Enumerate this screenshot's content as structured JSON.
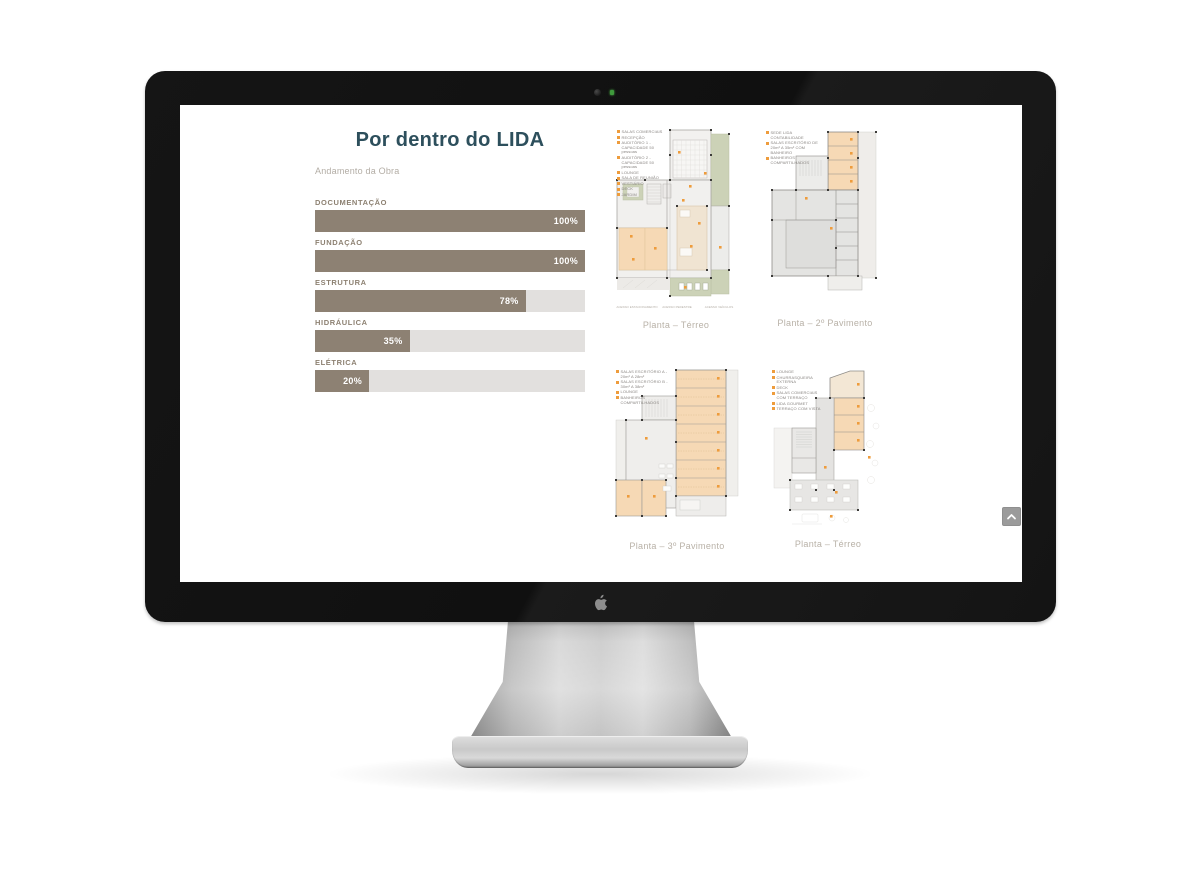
{
  "device": {
    "brand_logo": "apple-logo",
    "camera": "webcam",
    "led": "camera-indicator-green"
  },
  "page": {
    "title": "Por dentro do LIDA",
    "subtitle": "Andamento da Obra"
  },
  "progress": {
    "items": [
      {
        "label": "DOCUMENTAÇÃO",
        "percent": 100,
        "percent_label": "100%"
      },
      {
        "label": "FUNDAÇÃO",
        "percent": 100,
        "percent_label": "100%"
      },
      {
        "label": "ESTRUTURA",
        "percent": 78,
        "percent_label": "78%"
      },
      {
        "label": "HIDRÁULICA",
        "percent": 35,
        "percent_label": "35%"
      },
      {
        "label": "ELÉTRICA",
        "percent": 20,
        "percent_label": "20%"
      }
    ],
    "bar_color": "#8d8173",
    "track_color": "#e2e0de"
  },
  "plans": [
    {
      "caption": "Planta – Térreo",
      "legend": [
        "SALAS COMERCIAIS",
        "RECEPÇÃO",
        "AUDITÓRIO 1 - CAPACIDADE 50 pessoas",
        "AUDITÓRIO 2 - CAPACIDADE 50 pessoas",
        "LOUNGE",
        "SALA DE REUNIÃO",
        "VESTIÁRIO",
        "DECK",
        "JARDIM"
      ],
      "access": [
        "ACESSO ESTACIONAMENTO",
        "ACESSO PEDESTRE",
        "ACESSO VEÍCULOS"
      ]
    },
    {
      "caption": "Planta – 2º Pavimento",
      "legend": [
        "SEDE LIDA CONTABILIDADE",
        "SALAS ESCRITÓRIO DE 20m² A 35m² COM BANHEIRO",
        "BANHEIROS COMPARTILHADOS"
      ]
    },
    {
      "caption": "Planta – 3º Pavimento",
      "legend": [
        "SALAS ESCRITÓRIO A - 20m² A 28m²",
        "SALAS ESCRITÓRIO B - 30m² A 38m²",
        "LOUNGE",
        "BANHEIROS COMPARTILHADOS"
      ]
    },
    {
      "caption": "Planta – Térreo",
      "legend": [
        "LOUNGE",
        "CHURRASQUEIRA EXTERNA",
        "DECK",
        "SALAS COMERCIAIS COM TERRAÇO",
        "LIDA GOURMET",
        "TERRAÇO COM VISTA"
      ]
    }
  ],
  "colors": {
    "title": "#2d4f5c",
    "plan_room_orange": "#f6d9b5",
    "plan_green": "#ccd2b7",
    "legend_marker": "#ee9c3c",
    "caption": "#b8b1a7"
  },
  "scroll_top": {
    "icon": "chevron-up"
  }
}
